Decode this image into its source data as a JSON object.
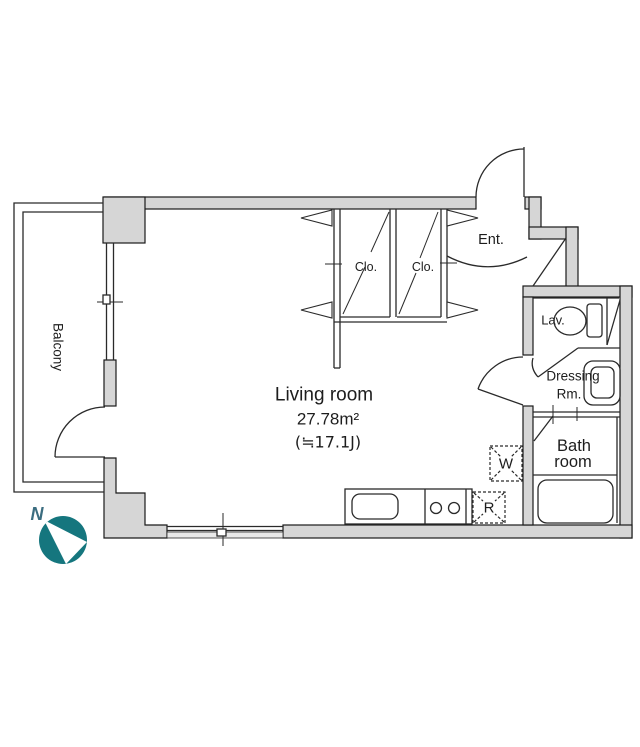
{
  "meta": {
    "kind": "apartment-floor-plan"
  },
  "colors": {
    "wall_fill": "#d6d6d6",
    "wall_stroke": "#1a1a1a",
    "line": "#2a2a2a",
    "text": "#1d1d1d",
    "sill": "#e9e9e9",
    "compass_teal": "#15767e",
    "north_text": "#3b6d80"
  },
  "rooms": {
    "living": {
      "name": "Living room",
      "area_sqm": "27.78m²",
      "area_jo": "(≒17.1J)"
    },
    "balcony": {
      "name": "Balcony"
    },
    "entrance": {
      "name": "Ent."
    },
    "closet1": {
      "name": "Clo."
    },
    "closet2": {
      "name": "Clo."
    },
    "lavatory": {
      "name": "Lav."
    },
    "dressing": {
      "line1": "Dressing",
      "line2": "Rm."
    },
    "bathroom": {
      "line1": "Bath",
      "line2": "room"
    }
  },
  "fixtures": {
    "washer_label": "W",
    "refrigerator_label": "R"
  },
  "compass": {
    "north_label": "N"
  }
}
